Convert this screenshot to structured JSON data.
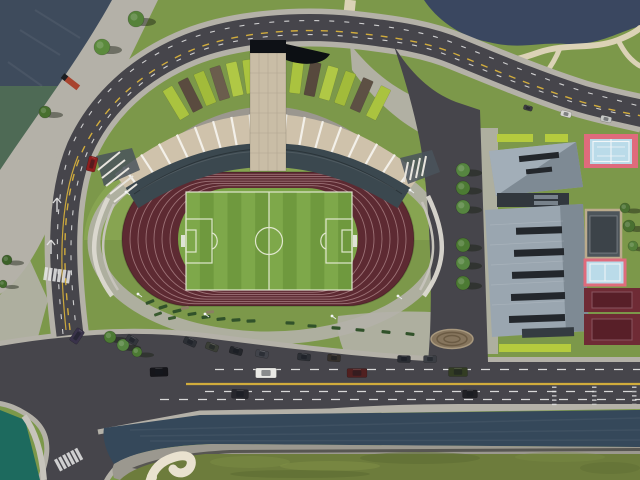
{
  "scene": {
    "description": "aerial-3d-render-of-stadium-sports-complex",
    "palette": {
      "grass_base": "#7c984a",
      "grass_bright": "#8fae57",
      "grass_in": "#7ba447",
      "pitch_a": "#7ea84a",
      "pitch_b": "#6f993e",
      "pitch_line": "#e9edda",
      "track": "#5d2a32",
      "track_line": "#ad8387",
      "sidewalk": "#b4b1a8",
      "road": "#46454b",
      "road_white": "#e8e8e8",
      "road_yellow": "#d9b23c",
      "water_dark": "#3e4b5c",
      "water_green": "#4e6a55",
      "water_teal": "#1d6a5e",
      "water_pond": "#3a4760",
      "water_canal": "#35485a",
      "roof": "#cfc2ab",
      "roof_rib": "#f3f0e9",
      "seat": "#3b484f",
      "band_gray": "#9b978f",
      "tower": "#c9bda6",
      "tower_cap": "#0e1116",
      "bldg_light": "#9aa6b0",
      "bldg_mid": "#97a3ad",
      "bldg_dark": "#7e8a94",
      "vent": "#23272c",
      "court_pink": "#df6b7c",
      "court_blue": "#badbe9",
      "court_maroon": "#6f2b35",
      "court_maroon_in": "#581f28",
      "lime": "#b5cb3e",
      "path_cream": "#dbd2b6",
      "bank_gray": "#9b988f",
      "bench_red": "#a8432e",
      "shadow": "rgba(25,30,18,0.45)"
    },
    "track_lanes": 6,
    "pitch_stripes": 12,
    "roof_ribs": 17,
    "fan_panels": [
      "#aac33f",
      "#5a4b3f",
      "#a2bb3a",
      "#6b5d4d",
      "#b0c845",
      "#aac33f",
      null,
      null,
      "#aac33f",
      "#57493d",
      "#b0c845",
      "#a2bb3a",
      "#5d5044",
      "#aac33f"
    ],
    "trees": [
      {
        "x": 102,
        "y": 47,
        "r": 8,
        "c": "#5b8a3c"
      },
      {
        "x": 136,
        "y": 19,
        "r": 8,
        "c": "#55823a"
      },
      {
        "x": 45,
        "y": 112,
        "r": 6,
        "c": "#486f2e"
      },
      {
        "x": 7,
        "y": 260,
        "r": 5,
        "c": "#3c6128"
      },
      {
        "x": 3,
        "y": 284,
        "r": 4,
        "c": "#436b2d"
      },
      {
        "x": 463,
        "y": 170,
        "r": 7,
        "c": "#568540"
      },
      {
        "x": 463,
        "y": 188,
        "r": 7,
        "c": "#4c7a33"
      },
      {
        "x": 463,
        "y": 207,
        "r": 7,
        "c": "#568540"
      },
      {
        "x": 463,
        "y": 245,
        "r": 7,
        "c": "#4c7a33"
      },
      {
        "x": 463,
        "y": 263,
        "r": 7,
        "c": "#568540"
      },
      {
        "x": 463,
        "y": 283,
        "r": 7,
        "c": "#4c7a33"
      },
      {
        "x": 110,
        "y": 337,
        "r": 6,
        "c": "#4c7a33"
      },
      {
        "x": 123,
        "y": 345,
        "r": 6,
        "c": "#558540"
      },
      {
        "x": 137,
        "y": 352,
        "r": 5,
        "c": "#4c7a33"
      },
      {
        "x": 629,
        "y": 226,
        "r": 6,
        "c": "#4a7031"
      },
      {
        "x": 633,
        "y": 246,
        "r": 5,
        "c": "#55803a"
      },
      {
        "x": 625,
        "y": 208,
        "r": 5,
        "c": "#4a7031"
      }
    ],
    "hedges": [
      {
        "x": 150,
        "y": 302,
        "w": 9,
        "h": 3.2,
        "rot": -22,
        "c": "#31522a"
      },
      {
        "x": 163,
        "y": 307,
        "w": 9,
        "h": 3.2,
        "rot": -18,
        "c": "#31522a"
      },
      {
        "x": 177,
        "y": 311,
        "w": 9,
        "h": 3.2,
        "rot": -14,
        "c": "#31522a"
      },
      {
        "x": 192,
        "y": 314,
        "w": 9,
        "h": 3.2,
        "rot": -10,
        "c": "#31522a"
      },
      {
        "x": 206,
        "y": 317,
        "w": 9,
        "h": 3.2,
        "rot": -8,
        "c": "#31522a"
      },
      {
        "x": 221,
        "y": 319,
        "w": 9,
        "h": 3.2,
        "rot": -6,
        "c": "#31522a"
      },
      {
        "x": 236,
        "y": 320,
        "w": 9,
        "h": 3.2,
        "rot": -4,
        "c": "#31522a"
      },
      {
        "x": 251,
        "y": 321,
        "w": 9,
        "h": 3.2,
        "rot": -2,
        "c": "#31522a"
      },
      {
        "x": 158,
        "y": 314,
        "w": 8,
        "h": 3,
        "rot": -20,
        "c": "#3a5c30"
      },
      {
        "x": 172,
        "y": 318,
        "w": 8,
        "h": 3,
        "rot": -12,
        "c": "#3a5c30"
      },
      {
        "x": 185,
        "y": 308,
        "w": 8,
        "h": 3,
        "rot": -12,
        "c": "#8a7f63"
      },
      {
        "x": 210,
        "y": 312,
        "w": 8,
        "h": 3,
        "rot": -6,
        "c": "#8a7f63"
      },
      {
        "x": 290,
        "y": 323,
        "w": 9,
        "h": 3.2,
        "rot": 2,
        "c": "#31522a"
      },
      {
        "x": 312,
        "y": 326,
        "w": 9,
        "h": 3.2,
        "rot": 3,
        "c": "#31522a"
      },
      {
        "x": 336,
        "y": 328,
        "w": 9,
        "h": 3.2,
        "rot": 4,
        "c": "#31522a"
      },
      {
        "x": 360,
        "y": 330,
        "w": 9,
        "h": 3.2,
        "rot": 5,
        "c": "#31522a"
      },
      {
        "x": 386,
        "y": 332,
        "w": 9,
        "h": 3.2,
        "rot": 6,
        "c": "#31522a"
      },
      {
        "x": 410,
        "y": 334,
        "w": 9,
        "h": 3.2,
        "rot": 7,
        "c": "#31522a"
      }
    ],
    "cars": [
      {
        "x": 92,
        "y": 164,
        "w": 9,
        "h": 15,
        "rot": 14,
        "c": "#8e1f1f"
      },
      {
        "x": 77,
        "y": 336,
        "w": 9,
        "h": 15,
        "rot": 34,
        "c": "#39324a"
      },
      {
        "x": 159,
        "y": 372,
        "w": 18,
        "h": 9,
        "rot": -2,
        "c": "#15151a"
      },
      {
        "x": 266,
        "y": 373,
        "w": 21,
        "h": 10,
        "rot": 0,
        "c": "#e9e9e5"
      },
      {
        "x": 240,
        "y": 394,
        "w": 17,
        "h": 9,
        "rot": 2,
        "c": "#26262c"
      },
      {
        "x": 357,
        "y": 373,
        "w": 20,
        "h": 9,
        "rot": 0,
        "c": "#512020"
      },
      {
        "x": 458,
        "y": 372,
        "w": 19,
        "h": 9,
        "rot": 0,
        "c": "#333d23"
      },
      {
        "x": 470,
        "y": 394,
        "w": 15,
        "h": 8,
        "rot": 0,
        "c": "#202024"
      },
      {
        "x": 566,
        "y": 114,
        "w": 11,
        "h": 6,
        "rot": 15,
        "c": "#d7d7d3"
      },
      {
        "x": 606,
        "y": 119,
        "w": 11,
        "h": 6,
        "rot": 13,
        "c": "#c6c8c6"
      },
      {
        "x": 528,
        "y": 108,
        "w": 9,
        "h": 5,
        "rot": 15,
        "c": "#3c3c40"
      },
      {
        "x": 190,
        "y": 342,
        "w": 13,
        "h": 7,
        "rot": 24,
        "c": "#2c2f35"
      },
      {
        "x": 212,
        "y": 347,
        "w": 13,
        "h": 7,
        "rot": 20,
        "c": "#3a3e36"
      },
      {
        "x": 236,
        "y": 351,
        "w": 13,
        "h": 7,
        "rot": 15,
        "c": "#24262b"
      },
      {
        "x": 262,
        "y": 354,
        "w": 13,
        "h": 7,
        "rot": 11,
        "c": "#41434a"
      },
      {
        "x": 304,
        "y": 357,
        "w": 13,
        "h": 7,
        "rot": 6,
        "c": "#2c2f35"
      },
      {
        "x": 334,
        "y": 358,
        "w": 13,
        "h": 7,
        "rot": 4,
        "c": "#35302b"
      },
      {
        "x": 404,
        "y": 359,
        "w": 13,
        "h": 7,
        "rot": 2,
        "c": "#2a2d33"
      },
      {
        "x": 430,
        "y": 359,
        "w": 13,
        "h": 7,
        "rot": 0,
        "c": "#3b3e44"
      },
      {
        "x": 132,
        "y": 340,
        "w": 12,
        "h": 7,
        "rot": 30,
        "c": "#33363c"
      }
    ],
    "poles": [
      {
        "x": 126,
        "y": 192
      },
      {
        "x": 138,
        "y": 294
      },
      {
        "x": 398,
        "y": 296
      },
      {
        "x": 410,
        "y": 190
      },
      {
        "x": 205,
        "y": 314
      },
      {
        "x": 332,
        "y": 316
      }
    ],
    "crosswalks": [
      {
        "x": 45,
        "y": 267,
        "rot": 8,
        "n": 6
      },
      {
        "x": 54,
        "y": 460,
        "rot": -28,
        "n": 6
      }
    ],
    "ticks": {
      "cols": [
        552,
        592,
        632
      ],
      "y0": 386.5,
      "n": 5,
      "dy": 4.3,
      "w": 4.5,
      "h": 1.5
    }
  }
}
